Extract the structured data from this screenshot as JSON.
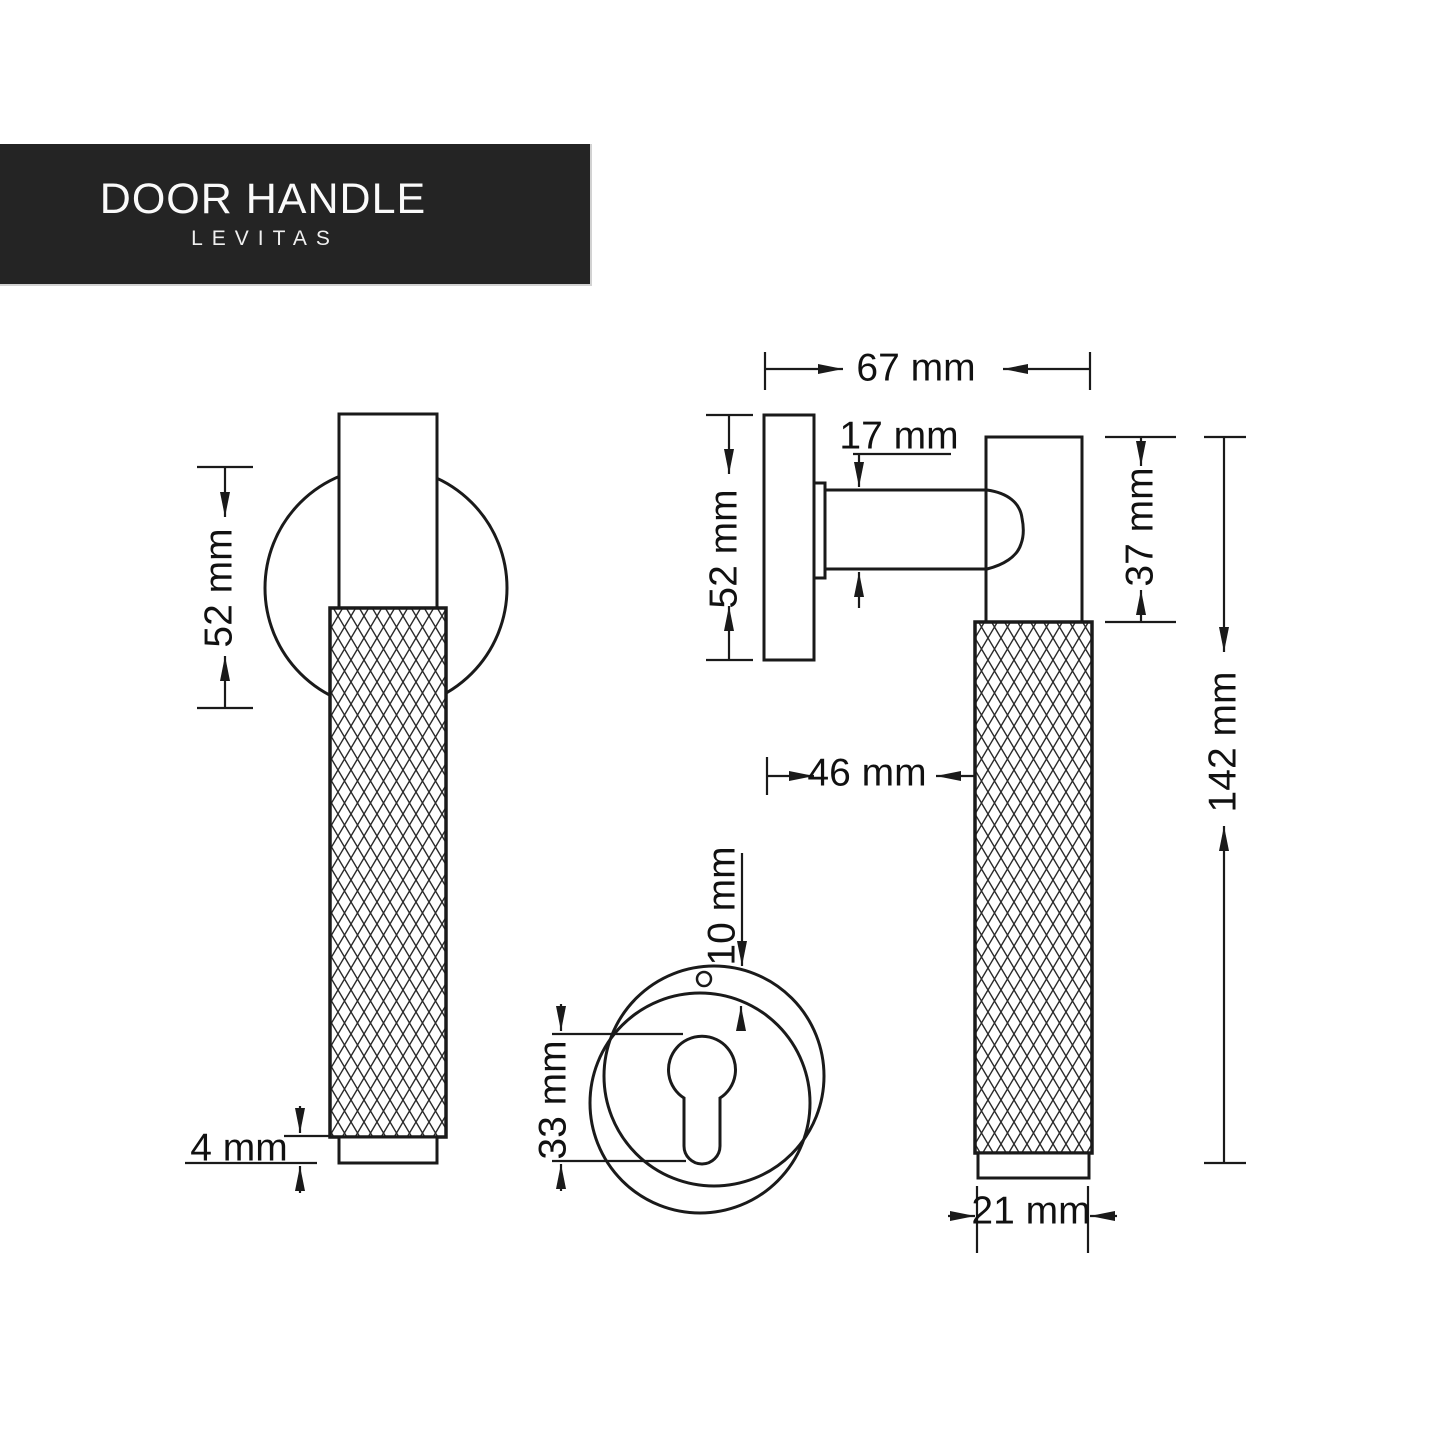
{
  "banner": {
    "title": "DOOR HANDLE",
    "subtitle": "LEVITAS"
  },
  "views": {
    "front": {
      "rosette_diameter": "52 mm",
      "cap_height": "4 mm"
    },
    "side": {
      "total_depth": "67 mm",
      "rosette_diameter": "52 mm",
      "spindle_width": "17 mm",
      "grip_clearance": "46 mm"
    },
    "handle": {
      "upper_section": "37 mm",
      "total_length": "142 mm",
      "grip_diameter": "21 mm"
    },
    "escutcheon": {
      "keyhole_height": "33 mm",
      "plate_thickness": "10 mm"
    }
  },
  "colors": {
    "background": "#ffffff",
    "line": "#1a1a1a",
    "banner_bg": "#242424",
    "banner_text": "#fafafa"
  }
}
